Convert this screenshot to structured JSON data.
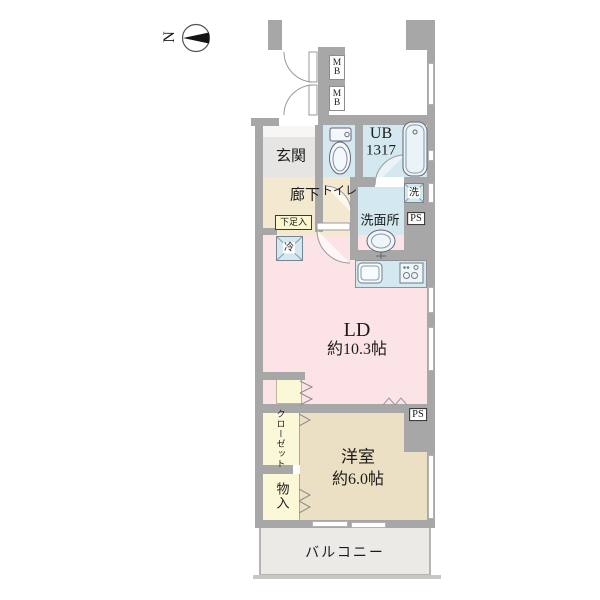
{
  "compass": {
    "north": "N"
  },
  "plan": {
    "mb_upper": "MB",
    "mb_lower": "MB",
    "genkan": "玄関",
    "toilet": "トイレ",
    "unit_bath": "UB",
    "unit_bath_size": "1317",
    "hallway": "廊下",
    "shoe_cabinet": "下足入",
    "washroom": "洗面所",
    "washer": "洗",
    "ps_upper": "PS",
    "refrigerator": "冷",
    "living_dining": "LD",
    "living_dining_size": "約10.3帖",
    "ps_lower": "PS",
    "western_room": "洋室",
    "western_room_size": "約6.0帖",
    "closet": "クローゼット",
    "storage": "物入",
    "balcony": "バルコニー"
  },
  "colors": {
    "wall": "#a7a7a7",
    "wet_area": "#d4e8ef",
    "hallway": "#f2e9d0",
    "living_dining": "#fce3e6",
    "western_room": "#ece0c4",
    "closet": "#fbf8d8",
    "genkan": "#e6e5e3",
    "balcony": "#ebeae7"
  }
}
